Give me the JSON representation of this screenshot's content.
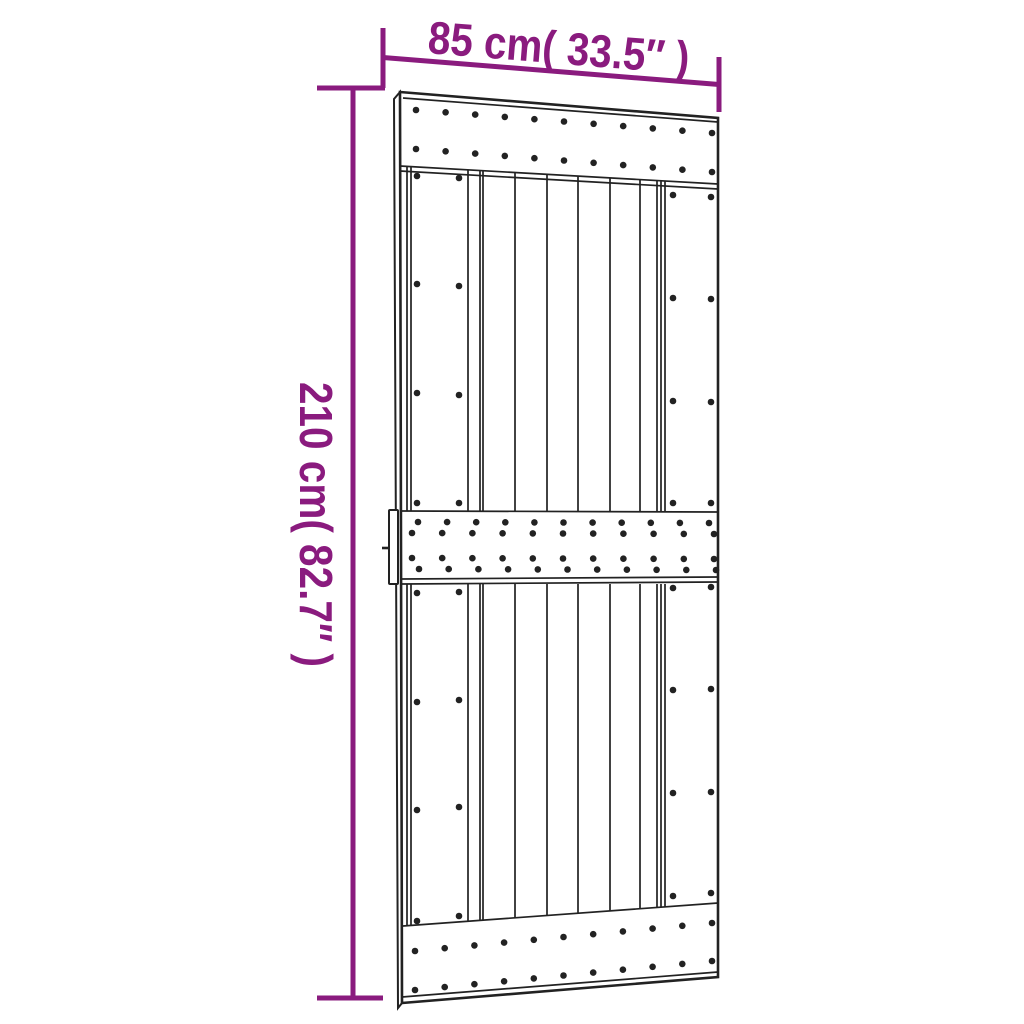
{
  "diagram": {
    "kind": "product-dimension-diagram",
    "subject": "barn door with three nailed cross rails, side stiles, vertical planks and left pull handle",
    "background": "#ffffff"
  },
  "dimensions": {
    "width_label": "85 cm( 33.5″ )",
    "height_label": "210 cm( 82.7″ )"
  },
  "colors": {
    "accent": "#8a1b7e",
    "ink": "#222222",
    "paper": "#ffffff"
  },
  "door": {
    "nail_radius": 3.3,
    "nail_rows": [
      {
        "x0": 416,
        "x1": 712,
        "n": 11,
        "y0": 110,
        "y1": 133
      },
      {
        "x0": 416,
        "x1": 712,
        "n": 11,
        "y0": 149,
        "y1": 172
      },
      {
        "x0": 418,
        "x1": 709,
        "n": 11,
        "y0": 522,
        "y1": 523
      },
      {
        "x0": 412,
        "x1": 714,
        "n": 11,
        "y0": 533,
        "y1": 534
      },
      {
        "x0": 412,
        "x1": 714,
        "n": 11,
        "y0": 558,
        "y1": 559
      },
      {
        "x0": 419,
        "x1": 716,
        "n": 11,
        "y0": 569,
        "y1": 570
      },
      {
        "x0": 415,
        "x1": 712,
        "n": 11,
        "y0": 951,
        "y1": 923
      },
      {
        "x0": 415,
        "x1": 712,
        "n": 11,
        "y0": 990,
        "y1": 961
      },
      {
        "x0": 417,
        "x1": 459,
        "n": 2,
        "y0": 176,
        "y1": 178
      },
      {
        "x0": 417,
        "x1": 459,
        "n": 2,
        "y0": 284,
        "y1": 286
      },
      {
        "x0": 417,
        "x1": 459,
        "n": 2,
        "y0": 393,
        "y1": 395
      },
      {
        "x0": 417,
        "x1": 459,
        "n": 2,
        "y0": 503,
        "y1": 503
      },
      {
        "x0": 673,
        "x1": 711,
        "n": 2,
        "y0": 195,
        "y1": 197
      },
      {
        "x0": 673,
        "x1": 711,
        "n": 2,
        "y0": 298,
        "y1": 299
      },
      {
        "x0": 673,
        "x1": 711,
        "n": 2,
        "y0": 401,
        "y1": 402
      },
      {
        "x0": 673,
        "x1": 711,
        "n": 2,
        "y0": 503,
        "y1": 503
      },
      {
        "x0": 417,
        "x1": 459,
        "n": 2,
        "y0": 593,
        "y1": 592
      },
      {
        "x0": 417,
        "x1": 459,
        "n": 2,
        "y0": 702,
        "y1": 700
      },
      {
        "x0": 417,
        "x1": 459,
        "n": 2,
        "y0": 810,
        "y1": 807
      },
      {
        "x0": 417,
        "x1": 459,
        "n": 2,
        "y0": 921,
        "y1": 916
      },
      {
        "x0": 673,
        "x1": 711,
        "n": 2,
        "y0": 588,
        "y1": 587
      },
      {
        "x0": 673,
        "x1": 711,
        "n": 2,
        "y0": 690,
        "y1": 689
      },
      {
        "x0": 673,
        "x1": 711,
        "n": 2,
        "y0": 793,
        "y1": 792
      },
      {
        "x0": 673,
        "x1": 711,
        "n": 2,
        "y0": 896,
        "y1": 893
      }
    ]
  }
}
